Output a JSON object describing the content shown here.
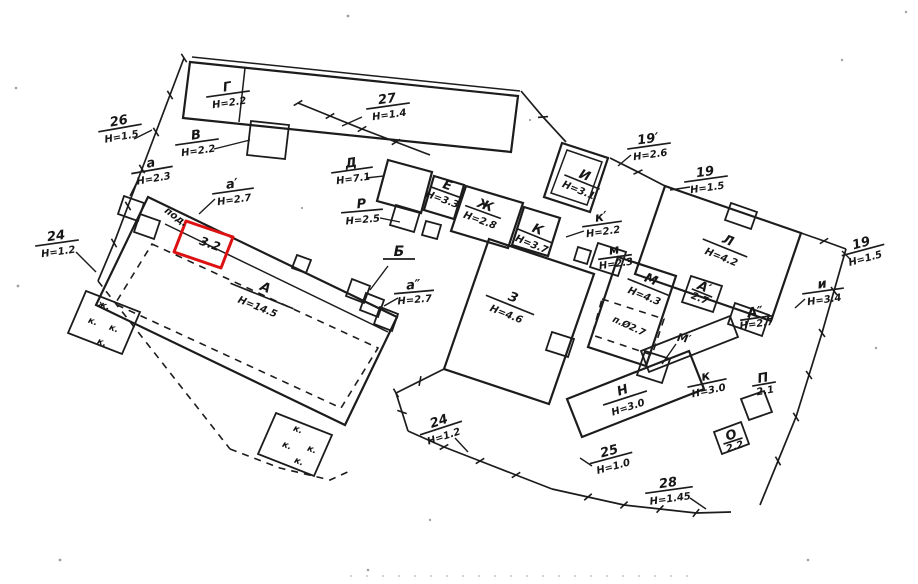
{
  "colors": {
    "ink": "#1c1c1c",
    "paper": "#ffffff",
    "highlight": "#dd1111"
  },
  "highlight": {
    "value": "3.2"
  },
  "labels": {
    "f26": {
      "top": "26",
      "bottom": "Н=1.5"
    },
    "g": {
      "top": "Г",
      "bottom": "Н=2.2"
    },
    "v": {
      "top": "В",
      "bottom": "Н=2.2"
    },
    "f27": {
      "top": "27",
      "bottom": "Н=1.4"
    },
    "a": {
      "top": "а",
      "bottom": "Н=2.3"
    },
    "a1": {
      "top": "а′",
      "bottom": "Н=2.7"
    },
    "d": {
      "top": "Д",
      "bottom": "Н=7.1"
    },
    "r": {
      "top": "Р",
      "bottom": "Н=2.5"
    },
    "e": {
      "top": "Е",
      "bottom": "Н=3.3"
    },
    "zh": {
      "top": "Ж",
      "bottom": "Н=2.8"
    },
    "f24w": {
      "top": "24",
      "bottom": "Н=1.2"
    },
    "pod": {
      "text": "под."
    },
    "b32": {
      "text": "3.2"
    },
    "bldA": {
      "top": "А",
      "bottom": "Н=14.5"
    },
    "b": {
      "text": "Б"
    },
    "a2": {
      "top": "а″",
      "bottom": "Н=2.7"
    },
    "z": {
      "top": "З",
      "bottom": "Н=4.6"
    },
    "k": {
      "top": "К",
      "bottom": "Н=3.7"
    },
    "k1": {
      "top": "к′",
      "bottom": "Н=2.2"
    },
    "m1": {
      "top": "м",
      "bottom": "Н=2.3"
    },
    "i": {
      "top": "И",
      "bottom": "Н=3.1"
    },
    "f19p": {
      "top": "19′",
      "bottom": "Н=2.6"
    },
    "f19a": {
      "top": "19",
      "bottom": "Н=1.5"
    },
    "l": {
      "top": "Л",
      "bottom": "Н=4.2"
    },
    "f19b": {
      "top": "19",
      "bottom": "Н=1.5"
    },
    "i1": {
      "top": "и",
      "bottom": "Н=3.4"
    },
    "m": {
      "top": "М",
      "bottom": "Н=4.3"
    },
    "a1s": {
      "top": "А′",
      "bottom": "2.7"
    },
    "a2s": {
      "top": "А″",
      "bottom": "Н=2.7"
    },
    "pcell": {
      "text": "п.Ø2.7"
    },
    "mprime": {
      "text": "М′"
    },
    "n": {
      "top": "Н",
      "bottom": "Н=3.0"
    },
    "kn": {
      "top": "к",
      "bottom": "Н=3.0"
    },
    "p": {
      "top": "П",
      "bottom": "2.1"
    },
    "o": {
      "top": "О",
      "bottom": "2.2"
    },
    "f25": {
      "top": "25",
      "bottom": "Н=1.0"
    },
    "f28": {
      "top": "28",
      "bottom": "Н=1.45"
    },
    "f24s": {
      "top": "24",
      "bottom": "Н=1.2"
    }
  },
  "room_marks": {
    "left": [
      "ж.",
      "к.",
      "к.",
      "к."
    ],
    "bottom": [
      "к.",
      "к.",
      "к.",
      "к."
    ]
  }
}
